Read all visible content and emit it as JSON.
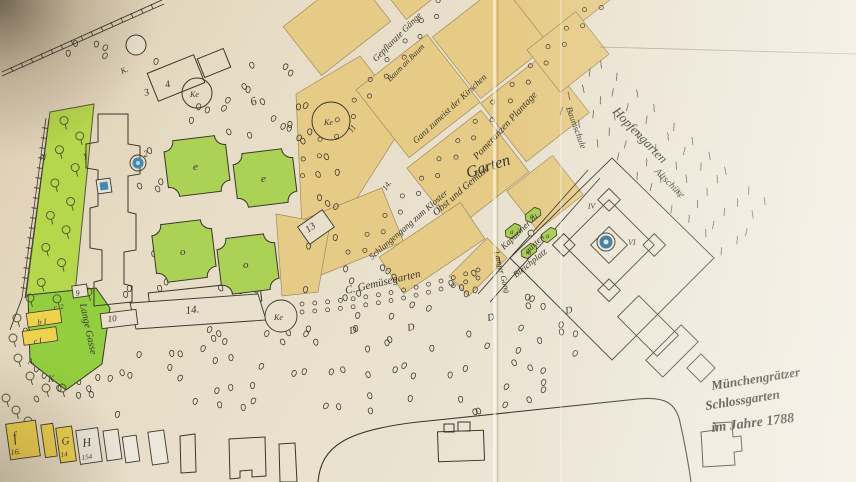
{
  "map_title": {
    "line1": "Münchengrätzer",
    "line2": "Schlossgarten",
    "line3": "im Jahre 1788"
  },
  "labels": {
    "gepflanzte_gaenge": "Gepflanzte Gänge",
    "baum_an_baum": "Baum an Baum",
    "kirschen": "Ganz zumeist der Kirschen",
    "pomeranzen": "Pomeranzen Plantage",
    "garten": "Garten",
    "obst_gemuese": "Obst und Gemüse",
    "kapuziner_1": "Kapuziner zu",
    "kapuziner_2": "garten",
    "schlangengang": "Schlangengang zum Kloster",
    "gemuesegarten": "C. Gemüsegarten",
    "bleichplatz": "Bleichplatz",
    "langer_gang": "Langer Gang",
    "hopfengarten": "Hopfengarten",
    "baumschule": "Baumschule",
    "altschuere": "Altschüre",
    "lange_gasse": "Lange Gasse"
  },
  "numbers": {
    "n1": "1",
    "n2": "2",
    "n3": "3",
    "n4": "4",
    "n6": "6",
    "n9": "9",
    "n10": "10",
    "n11": "11",
    "n13": "13",
    "n14_path": "14.",
    "n14_band": "14.",
    "n_strip": "N",
    "k_top": "K."
  },
  "circles": {
    "ke1": "Ke",
    "ke2": "Ke",
    "ke3": "Ke"
  },
  "roman": {
    "iv": "IV",
    "vi": "VI",
    "i": "I"
  },
  "letters": {
    "d": "D",
    "e": "e",
    "o": "o",
    "a": "a"
  },
  "legend": {
    "f": "f",
    "f_num": "16.",
    "g": "G",
    "g_num": "14",
    "h": "H",
    "h_num": "154",
    "b1": "b I",
    "c1": "c I",
    "c2": "c. 2",
    "a_dot": "A.",
    "k": "K"
  },
  "colors": {
    "paper": "#e8dfcc",
    "paper_light": "#f0ebe0",
    "block_yellow": "#e6cb87",
    "legend_yellow": "#eed24e",
    "parterre_green": "#abd155",
    "strip_green": "#b5d74c",
    "meadow_green": "#92ce3f",
    "fountain_blue": "#4189b4",
    "ink": "#3a362e"
  }
}
